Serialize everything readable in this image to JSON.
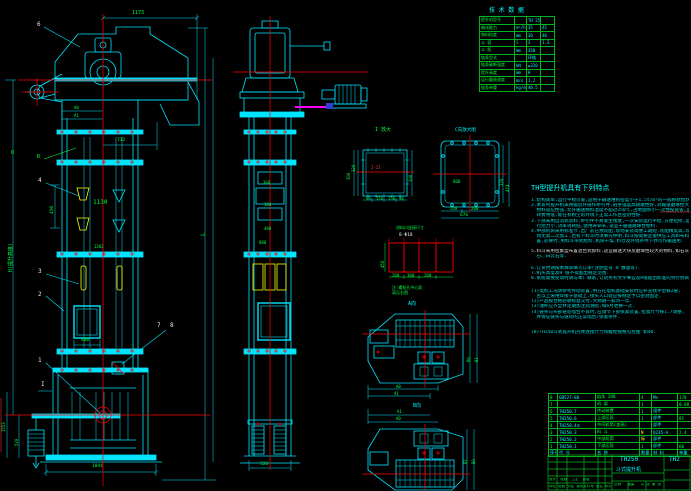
{
  "tech": {
    "title": "技 术 数 据",
    "rows": [
      [
        "提升机型号",
        "",
        "TH 250",
        ""
      ],
      [
        "输送能力",
        "m³/h",
        "35",
        "45"
      ],
      [
        "物料粒度",
        "mm",
        "30",
        "40"
      ],
      [
        "斗  容",
        "l",
        "3",
        "1.3"
      ],
      [
        "斗  距",
        "mm",
        "350",
        ""
      ],
      [
        "链条型式",
        "",
        "环链",
        ""
      ],
      [
        "链条破断强度",
        "kN",
        "≥320",
        ""
      ],
      [
        "提升高度",
        "mm",
        "H",
        ""
      ],
      [
        "运行圆周速度",
        "m/s",
        "1.2",
        ""
      ],
      [
        "链条单重",
        "kg/m",
        "40.5",
        ""
      ]
    ]
  },
  "features": {
    "title": "TH型提升机具有下列特点",
    "lines": [
      "1.结构简单,运行平稳可靠,适用于输送堆积密度小于1.5t/m³的一般粉状粒状物料",
      "2.本系列提升机采用锻造环链作牵引件,链条强度高耐磨性好,对输送磨琢性大的",
      "  物料适应性强,允许输送物料温度不超过250℃,占地面积小一次性投资省,运",
      "  转费用低,能在有粉尘的环境下正常工作且密封性好.",
      "3.下部采用自流式装料,牵引件不易发生堵塞,一次安装运行平稳,方便检修,运",
      "  行阻力小,功率消耗低,使用寿命长,适宜于输送磨琢性物料.",
      "4.中部机筒采用标准节,出厂前已预装配,现场安装简便工期短,装配精度高,现",
      "  场无需二次加工,若有下料斗时须事先申明,料斗按需要定量供应工具和布料装",
      "  置,必要时,用料斗带式给料,机筒干燥,料仓及环境条件下亦可作输送用.",
      "5.料斗采用密集型布置混合式卸料,适宜输送大块及磨琢性较大的物料,如石灰",
      "  石、白云石等.",
      "6.订货时请按本样单填写订单(注明型号 H 数量等).",
      "7.机头高度及H 值不得超出规定范围.",
      "8.系统需要变动时请与本厂联系,订货另有文字事宜及H值超出标准的另行协商.",
      "(1)电机工况请参考传动装置,供方在电机基础安装时应补充找平垫铁2层,",
      "  且以上采用焊接于基础上,接头入口处应按规定予以密封固定.",
      "(2)产品按合格验收标准交付,大修期一般为一年.",
      "(3)油杯应齐全并定期加注润滑脂,每6月更换一次.",
      "(4)链条与头部链轮啮合不良时,应调节下部张紧装置,拉紧尺寸按1.7调整,",
      "  并保证链条与链轮的正常啮合/张紧条件.",
      "(8)TH250斗式提升机壳体连接尺寸和螺栓规格见左图 如40."
    ]
  },
  "fv": {
    "c6": "6",
    "cD": "D",
    "cB": "B",
    "c4": "4",
    "c3": "3",
    "c2": "2",
    "c1": "1",
    "c7": "7",
    "c8": "8",
    "mI": "I",
    "d1173": "1173",
    "dA0": "A0",
    "dA1": "A1",
    "d712": "712",
    "d450": "450",
    "d1130": "1130",
    "d1202": "1202",
    "d400": "400",
    "d1044": "1044",
    "d1553": "1553",
    "d520": "520",
    "L": "L",
    "H": "H(提升高度)"
  },
  "sv": {
    "d360": "360",
    "d180": "180",
    "d400": "400",
    "d888": "888",
    "d526": "526"
  },
  "di": {
    "title": "I 放大",
    "red": "I-II",
    "d390": "390",
    "d320": "320",
    "d300": "300",
    "b": [
      "90",
      "156",
      "156",
      "90"
    ]
  },
  "dc": {
    "title": "C向放大图",
    "d600": "600",
    "d240": "240",
    "d200": "200",
    "d676": "676",
    "d320": "320",
    "d474": "474"
  },
  "bl": {
    "t1": "进料口连接尺寸",
    "t2": "8-Φ18",
    "d450": "450",
    "b": [
      "200",
      "300",
      "200"
    ],
    "n1": "注:螺栓孔中心距",
    "n2": "离见右图"
  },
  "pa": {
    "label": "A向",
    "a0": "A0",
    "a1": "A1",
    "b0": "B0",
    "b1": "B1"
  },
  "pb": {
    "label": "B向",
    "a0": "A0",
    "a1": "A1",
    "b0": "B0",
    "b1": "B1"
  },
  "bom": {
    "header": [
      "序号",
      "代  号",
      "名  称",
      "数量",
      "材  料",
      "单重"
    ],
    "rows": [
      [
        "8",
        "GB527-88",
        "链条 20B",
        "4",
        "Mn",
        "170"
      ],
      [
        "7",
        "",
        "机  架",
        "1",
        "",
        "0.08"
      ],
      [
        "6",
        "TH250.7",
        "传动装置",
        "1",
        "组件",
        ""
      ],
      [
        "5",
        "TH250.6",
        "上部区段",
        "1",
        "部件",
        "85"
      ],
      [
        "4",
        "TH250.4①",
        "中间机筒(加高)",
        "",
        "部件",
        ""
      ],
      [
        "3",
        "TH250.3",
        "料  斗",
        "N",
        "Q235-A",
        "2.4"
      ],
      [
        "2",
        "TH250.2",
        "中部机筒",
        "标",
        "部件",
        ""
      ],
      [
        "1",
        "TH250.1",
        "下部区段",
        "1",
        "部件",
        "60"
      ]
    ]
  },
  "tb": {
    "model": "TH250",
    "name": "斗式提升机",
    "right": "TH2",
    "rev": "标记 处数 分区 更改文件号 签名 年月日",
    "sign": "设计  校核  工艺  批准",
    "scale": "比例   重量   共 张 第 张"
  }
}
